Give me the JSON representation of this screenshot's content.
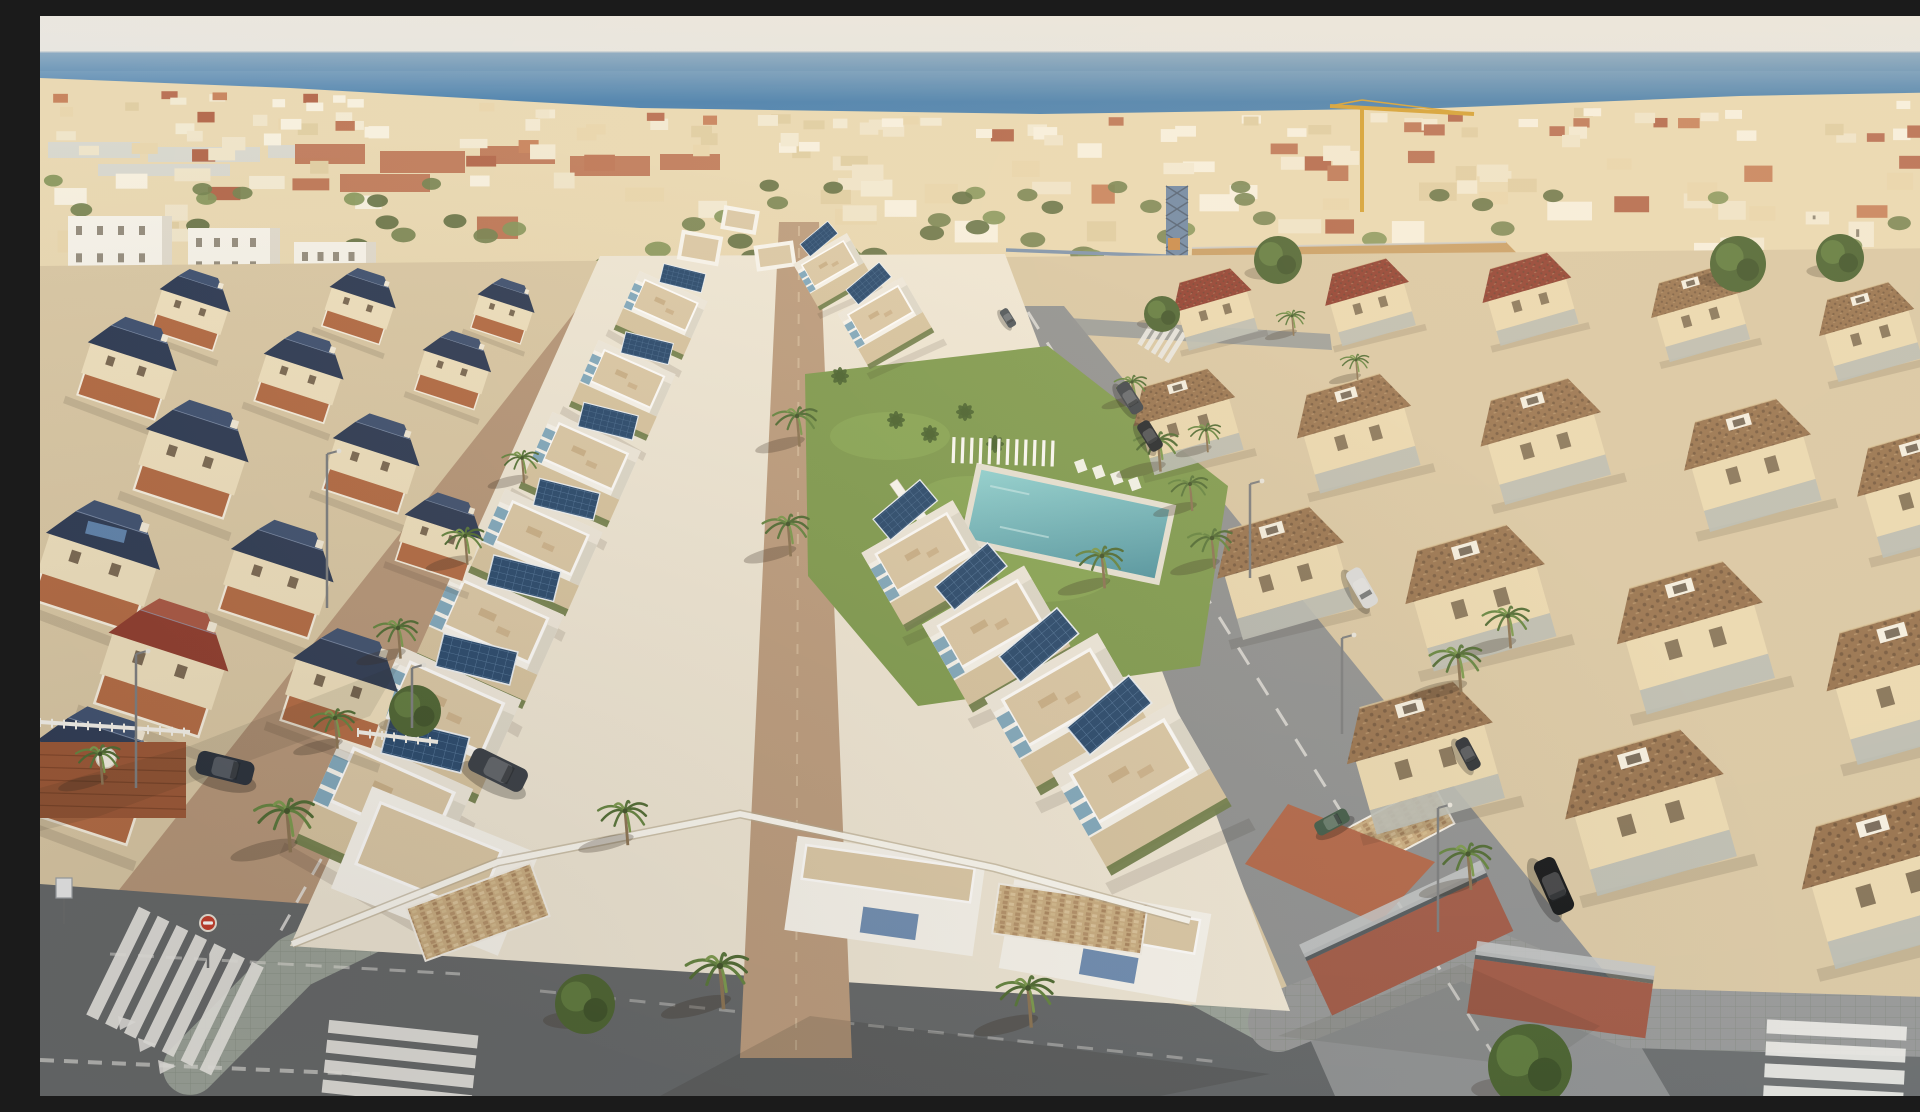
{
  "meta": {
    "description": "Aerial drone photo of a coastal Spanish town: new white villas with rooftop terraces and solar panels around a communal pool garden, flanked by an older neighbourhood with navy tiled roofs on the left and terracotta roofed houses on the right, Mediterranean sea on the horizon, construction cranes, palm lined streets and zebra crossings."
  },
  "palette": {
    "sky_top": "#eae7e0",
    "sky_bottom": "#dfe3e6",
    "sea_near_horizon": "#8cabc3",
    "sea_mid": "#3e79ab",
    "sea_deep": "#4d86b4",
    "town_base": "#e8d7b0",
    "town_white": "#f7f1e0",
    "town_terracotta": "#b96f4e",
    "ground": "#d9c8a6",
    "dev_ground": "#efe8d8",
    "dev_white": "#f8f6f0",
    "terrace_tan": "#dbc9a8",
    "walkway": "#bb9c7f",
    "hedge": "#6f7e4c",
    "solar_panel": "#24476e",
    "awning_blue": "#7fa9c0",
    "lawn": "#7d9b4f",
    "pool_light": "#8fd4d6",
    "pool_deep": "#4f96a4",
    "street_left": "#b5967a",
    "street_right": "#8e9193",
    "street_bottom": "#63676a",
    "sidewalk": "#9aa39b",
    "navy_roof": "#2c3a55",
    "navy_roof_light": "#3d5071",
    "red_roof": "#8e3b2e",
    "brown_roof": "#96724f",
    "old_wall": "#eee0bf",
    "old_floor": "#b26a44",
    "brick_wall": "#a05a48",
    "stone_wall": "#c9ad82",
    "dirt": "#c89e66",
    "crane_yellow": "#d4a033",
    "crane_blue": "#6d87a6",
    "palm_green": "#628440",
    "stripe_white": "#e9e9e6"
  },
  "scene": {
    "horizonY": 36,
    "seaBottom": 118,
    "townTop": [
      [
        0,
        62
      ],
      [
        250,
        72
      ],
      [
        600,
        92
      ],
      [
        1000,
        98
      ],
      [
        1400,
        92
      ],
      [
        1700,
        80
      ],
      [
        1920,
        76
      ]
    ],
    "townBottom": [
      [
        0,
        262
      ],
      [
        200,
        280
      ],
      [
        380,
        300
      ],
      [
        520,
        282
      ],
      [
        700,
        256
      ],
      [
        900,
        246
      ],
      [
        1150,
        258
      ],
      [
        1380,
        300
      ],
      [
        1600,
        330
      ],
      [
        1780,
        345
      ],
      [
        1920,
        320
      ]
    ],
    "townGen": {
      "seed": 11,
      "buildings": 175,
      "greens": 80
    },
    "warehouses": [
      [
        8,
        126,
        92,
        16
      ],
      [
        108,
        131,
        112,
        15
      ],
      [
        228,
        129,
        72,
        13
      ],
      [
        58,
        148,
        132,
        12
      ]
    ],
    "whiteBlocks": [
      [
        28,
        200,
        104,
        100
      ],
      [
        148,
        212,
        92,
        88
      ],
      [
        254,
        226,
        82,
        72
      ]
    ],
    "terracottaStrip": [
      [
        255,
        128,
        70,
        20
      ],
      [
        340,
        135,
        85,
        22
      ],
      [
        440,
        130,
        75,
        18
      ],
      [
        530,
        140,
        80,
        20
      ],
      [
        620,
        138,
        60,
        16
      ],
      [
        300,
        158,
        90,
        18
      ]
    ],
    "craneYellow": {
      "mastX": 1322,
      "mastTop": 92,
      "mastBottom": 196,
      "jib": [
        1290,
        90,
        1434,
        98
      ]
    },
    "craneBlue": {
      "x": 1126,
      "top": 170,
      "w": 22,
      "bottom": 352,
      "jibY": 240,
      "jibX2": 966
    },
    "dirtLot": [
      [
        1152,
        232
      ],
      [
        1466,
        226
      ],
      [
        1538,
        300
      ],
      [
        1288,
        334
      ],
      [
        1150,
        302
      ]
    ],
    "leftStreet": [
      [
        574,
        246
      ],
      [
        656,
        246
      ],
      [
        430,
        930
      ],
      [
        60,
        898
      ]
    ],
    "intersection": [
      [
        0,
        868
      ],
      [
        430,
        900
      ],
      [
        470,
        1080
      ],
      [
        0,
        1080
      ]
    ],
    "bottomStreet": [
      [
        60,
        898
      ],
      [
        430,
        900
      ],
      [
        1250,
        1002
      ],
      [
        1345,
        1080
      ],
      [
        0,
        1080
      ],
      [
        0,
        868
      ]
    ],
    "rightStreet": [
      [
        948,
        290
      ],
      [
        1024,
        290
      ],
      [
        1665,
        1080
      ],
      [
        1295,
        1080
      ]
    ],
    "rightBottomRoad": [
      [
        1580,
        995
      ],
      [
        1920,
        1005
      ],
      [
        1920,
        1080
      ],
      [
        1630,
        1080
      ]
    ],
    "topRoad": [
      [
        930,
        296
      ],
      [
        1290,
        318
      ],
      [
        1292,
        334
      ],
      [
        928,
        312
      ]
    ],
    "sidewalkFront": [
      [
        150,
        1052
      ],
      [
        255,
        946
      ],
      [
        458,
        848
      ],
      [
        700,
        800
      ],
      [
        958,
        854
      ],
      [
        1232,
        1002
      ]
    ],
    "sidewalkRight": [
      [
        1238,
        1006
      ],
      [
        1422,
        933
      ],
      [
        1590,
        1002
      ],
      [
        1920,
        1012
      ]
    ],
    "sidewalkLeftDev": [
      [
        640,
        252
      ],
      [
        445,
        848
      ]
    ],
    "darkPathLeftDev": [
      [
        616,
        268
      ],
      [
        432,
        852
      ]
    ],
    "markings": [
      {
        "d": "M612,258 L240,916",
        "w": 3,
        "dash": "18 14",
        "o": 0.8
      },
      {
        "d": "M648,262 L414,898",
        "w": 2,
        "dash": "",
        "o": 0.5
      },
      {
        "d": "M988,296 L1468,1062",
        "w": 3,
        "dash": "20 16",
        "o": 0.75
      },
      {
        "d": "M70,938 L420,958",
        "w": 3,
        "dash": "16 12",
        "o": 0.5
      },
      {
        "d": "M500,975 L1180,1046",
        "w": 3,
        "dash": "16 14",
        "o": 0.4
      },
      {
        "d": "M0,1044 L320,1058",
        "w": 4,
        "dash": "14 10",
        "o": 0.6
      }
    ],
    "crosswalks": [
      {
        "x": 135,
        "y": 975,
        "rot": -64,
        "n": 7,
        "len": 120,
        "th": 13,
        "gap": 21
      },
      {
        "x": 360,
        "y": 1048,
        "rot": 6,
        "n": 4,
        "len": 150,
        "th": 13,
        "gap": 20
      },
      {
        "x": 1122,
        "y": 323,
        "rot": -58,
        "n": 5,
        "len": 34,
        "th": 5,
        "gap": 8
      },
      {
        "x": 1795,
        "y": 1047,
        "rot": 3,
        "n": 4,
        "len": 140,
        "th": 14,
        "gap": 22
      }
    ],
    "giveWay": [
      [
        78,
        1000
      ],
      [
        98,
        1022
      ],
      [
        118,
        1044
      ]
    ],
    "devGround": [
      [
        560,
        240
      ],
      [
        965,
        238
      ],
      [
        1250,
        995
      ],
      [
        250,
        930
      ]
    ],
    "walkway": [
      [
        739,
        206
      ],
      [
        779,
        206
      ],
      [
        812,
        1042
      ],
      [
        700,
        1042
      ]
    ],
    "garden": {
      "lawn": [
        [
          765,
          358
        ],
        [
          1008,
          330
        ],
        [
          1188,
          470
        ],
        [
          1160,
          650
        ],
        [
          878,
          690
        ],
        [
          768,
          560
        ]
      ],
      "pool": {
        "x": 1028,
        "y": 508,
        "w": 192,
        "h": 70,
        "rot": 12
      },
      "bench": {
        "x": 912,
        "y": 434,
        "slats": 12
      },
      "chairs": [
        [
          1034,
          446
        ],
        [
          1052,
          452
        ],
        [
          1070,
          458
        ],
        [
          1088,
          464
        ]
      ],
      "loungers": {
        "x": 862,
        "y": 478,
        "n": 7,
        "dx": 11,
        "dy": 13,
        "rot": 55
      },
      "bananas": [
        [
          856,
          404
        ],
        [
          890,
          418
        ],
        [
          925,
          396
        ],
        [
          800,
          360
        ],
        [
          955,
          428
        ]
      ]
    },
    "gardenPalms": [
      [
        757,
        400,
        0.85
      ],
      [
        748,
        508,
        0.9
      ],
      [
        1118,
        425,
        0.85
      ],
      [
        1172,
        522,
        0.85
      ]
    ],
    "devLeftRow": {
      "rot": 24,
      "items": [
        [
          624,
          292,
          0.6
        ],
        [
          586,
          366,
          0.68
        ],
        [
          544,
          444,
          0.78
        ],
        [
          500,
          526,
          0.86
        ],
        [
          454,
          610,
          0.96
        ],
        [
          404,
          696,
          1.06
        ],
        [
          350,
          786,
          1.14
        ]
      ]
    },
    "devRightRow": {
      "rot": -30,
      "items": [
        [
          790,
          250,
          0.5
        ],
        [
          842,
          300,
          0.6
        ],
        [
          884,
          540,
          0.85
        ],
        [
          952,
          612,
          0.95
        ],
        [
          1022,
          686,
          1.05
        ],
        [
          1094,
          760,
          1.12
        ]
      ]
    },
    "devTopBlocks": [
      [
        660,
        232,
        42,
        30,
        10
      ],
      [
        700,
        204,
        36,
        24,
        10
      ],
      [
        735,
        240,
        40,
        26,
        -8
      ]
    ],
    "frontBlocks": [
      {
        "x": 845,
        "y": 880,
        "w": 190,
        "h": 95,
        "rot": 8
      },
      {
        "x": 1065,
        "y": 925,
        "w": 200,
        "h": 90,
        "rot": 10
      }
    ],
    "cornerVilla": {
      "x": 395,
      "y": 855,
      "w": 180,
      "h": 110,
      "rot": 22
    },
    "stoneWalls": [
      [
        372,
        868,
        132,
        56,
        -20
      ],
      [
        955,
        878,
        150,
        50,
        8
      ],
      [
        1300,
        790,
        110,
        46,
        -28
      ]
    ],
    "terracePatio": [
      [
        1248,
        788
      ],
      [
        1395,
        846
      ],
      [
        1338,
        908
      ],
      [
        1205,
        848
      ]
    ],
    "boundaryWall": [
      [
        252,
        928
      ],
      [
        458,
        846
      ],
      [
        700,
        798
      ],
      [
        955,
        852
      ],
      [
        1150,
        905
      ]
    ],
    "leftVillas": {
      "rot": 18,
      "items": [
        [
          150,
          300,
          0.62,
          "navy"
        ],
        [
          318,
          296,
          0.58,
          "navy"
        ],
        [
          462,
          300,
          0.5,
          "navy"
        ],
        [
          86,
          360,
          0.78,
          "navy"
        ],
        [
          258,
          368,
          0.7,
          "navy"
        ],
        [
          412,
          360,
          0.6,
          "navy"
        ],
        [
          150,
          452,
          0.9,
          "navy"
        ],
        [
          330,
          455,
          0.76,
          "navy"
        ],
        [
          55,
          560,
          1.0,
          "navySolar"
        ],
        [
          235,
          572,
          0.9,
          "navy"
        ],
        [
          398,
          528,
          0.68,
          "navy"
        ],
        [
          120,
          662,
          1.05,
          "red"
        ],
        [
          298,
          682,
          0.92,
          "navy"
        ],
        [
          48,
          770,
          1.05,
          "navy"
        ]
      ]
    },
    "rightHouses": {
      "rot": -16,
      "items": [
        [
          1175,
          295,
          0.62,
          "red"
        ],
        [
          1330,
          288,
          0.66,
          "red"
        ],
        [
          1490,
          285,
          0.7,
          "red"
        ],
        [
          1660,
          300,
          0.72,
          "brown"
        ],
        [
          1830,
          318,
          0.75,
          "brown"
        ],
        [
          1148,
          408,
          0.8,
          "brown"
        ],
        [
          1318,
          420,
          0.9,
          "brown"
        ],
        [
          1505,
          428,
          0.95,
          "brown"
        ],
        [
          1712,
          452,
          1.0,
          "brown"
        ],
        [
          1885,
          478,
          1.0,
          "brown"
        ],
        [
          1245,
          560,
          1.0,
          "brown"
        ],
        [
          1440,
          585,
          1.1,
          "brown"
        ],
        [
          1655,
          625,
          1.15,
          "brown"
        ],
        [
          1868,
          672,
          1.2,
          "brown"
        ],
        [
          1385,
          745,
          1.15,
          "brown"
        ],
        [
          1610,
          800,
          1.25,
          "brown"
        ],
        [
          1850,
          870,
          1.3,
          "brown"
        ]
      ]
    },
    "brickWalls": [
      [
        1270,
        900,
        200,
        60,
        -25
      ],
      [
        1430,
        955,
        180,
        55,
        8
      ]
    ],
    "deck": [
      0,
      726,
      146,
      76
    ],
    "fences": [
      [
        0,
        706,
        150
      ],
      [
        318,
        716,
        80
      ]
    ],
    "palms": [
      [
        680,
        950,
        1.2
      ],
      [
        988,
        972,
        1.1
      ],
      [
        585,
        795,
        0.95
      ],
      [
        247,
        795,
        1.15
      ],
      [
        60,
        738,
        0.85
      ],
      [
        425,
        520,
        0.8
      ],
      [
        358,
        612,
        0.85
      ],
      [
        482,
        442,
        0.7
      ],
      [
        295,
        702,
        0.85
      ],
      [
        1062,
        540,
        0.9
      ],
      [
        1150,
        468,
        0.75
      ],
      [
        1418,
        640,
        1.0
      ],
      [
        1468,
        600,
        0.9
      ],
      [
        1428,
        838,
        1.0
      ],
      [
        1092,
        366,
        0.62
      ],
      [
        1166,
        414,
        0.62
      ],
      [
        1252,
        300,
        0.55
      ],
      [
        1316,
        344,
        0.55
      ]
    ],
    "trees": [
      [
        1238,
        244,
        24
      ],
      [
        1698,
        248,
        28
      ],
      [
        1800,
        242,
        24
      ],
      [
        1122,
        298,
        18
      ],
      [
        1490,
        1050,
        42
      ],
      [
        375,
        695,
        26
      ],
      [
        545,
        988,
        30
      ]
    ],
    "cars": [
      [
        185,
        752,
        58,
        24,
        14,
        "#252e3b"
      ],
      [
        458,
        754,
        60,
        25,
        26,
        "#343b45"
      ],
      [
        1090,
        382,
        34,
        14,
        58,
        "#3c434b"
      ],
      [
        1110,
        420,
        32,
        14,
        58,
        "#21262c"
      ],
      [
        1322,
        572,
        42,
        17,
        60,
        "#d9dbdc"
      ],
      [
        1428,
        738,
        34,
        14,
        62,
        "#2b3037"
      ],
      [
        1514,
        870,
        58,
        23,
        66,
        "#121519"
      ],
      [
        1292,
        806,
        36,
        15,
        -28,
        "#3f5a49"
      ],
      [
        968,
        302,
        20,
        9,
        58,
        "#49525a"
      ]
    ],
    "lamps": [
      [
        287,
        438,
        592
      ],
      [
        372,
        652,
        712
      ],
      [
        1210,
        468,
        562
      ],
      [
        1302,
        622,
        718
      ],
      [
        1398,
        792,
        916
      ],
      [
        96,
        638,
        772
      ]
    ],
    "stopSign": {
      "x": 168,
      "y": 915,
      "poleBottom": 952
    },
    "smallSign": [
      16,
      862,
      16,
      20
    ],
    "shadows": [
      {
        "pts": [
          [
            620,
            1080
          ],
          [
            770,
            1000
          ],
          [
            1230,
            1058
          ],
          [
            1120,
            1080
          ]
        ],
        "o": 0.14
      },
      {
        "pts": [
          [
            0,
            772
          ],
          [
            150,
            730
          ],
          [
            360,
            648
          ],
          [
            330,
            700
          ],
          [
            60,
            800
          ],
          [
            0,
            815
          ]
        ],
        "o": 0.1
      },
      {
        "pts": [
          [
            1238,
            1020
          ],
          [
            1422,
            948
          ],
          [
            1560,
            1010
          ],
          [
            1500,
            1052
          ]
        ],
        "o": 0.08
      }
    ]
  }
}
